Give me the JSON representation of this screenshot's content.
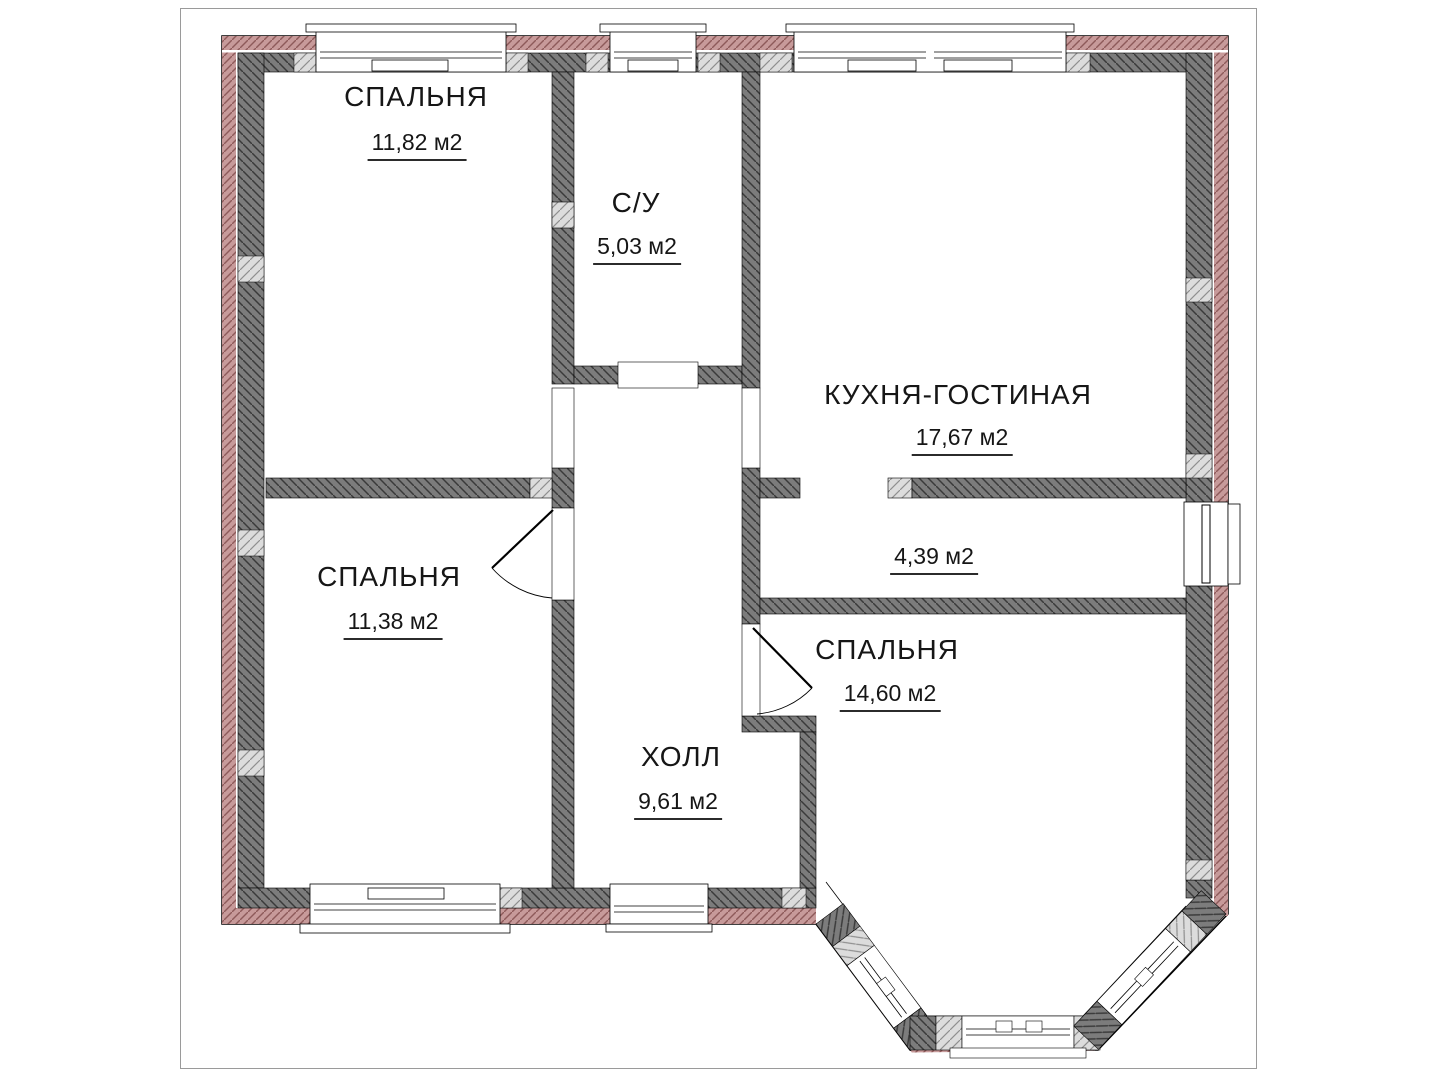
{
  "drawing": {
    "type": "architectural floor plan",
    "language": "ru",
    "area_unit": "м2"
  },
  "rooms": [
    {
      "id": "bedroom-top-left",
      "name": "СПАЛЬНЯ",
      "area": "11,82 м2"
    },
    {
      "id": "bathroom",
      "name": "С/У",
      "area": "5,03 м2"
    },
    {
      "id": "kitchen-living-room",
      "name": "КУХНЯ-ГОСТИНАЯ",
      "area": "17,67 м2"
    },
    {
      "id": "bedroom-middle-left",
      "name": "СПАЛЬНЯ",
      "area": "11,38 м2"
    },
    {
      "id": "corridor",
      "name": "",
      "area": "4,39 м2"
    },
    {
      "id": "bedroom-right",
      "name": "СПАЛЬНЯ",
      "area": "14,60 м2"
    },
    {
      "id": "hall",
      "name": "ХОЛЛ",
      "area": "9,61 м2"
    }
  ],
  "colors": {
    "brick_wall_fill": "#c79a9a",
    "brick_wall_hatch": "#8e5a5a",
    "block_wall_fill": "#7c7c7c",
    "block_wall_hatch": "#3a3a3a",
    "lintel_fill": "#dcdcdc",
    "lintel_hatch": "#8f8f8f",
    "outline": "#000000",
    "page_border": "#9a9a9a",
    "background": "#ffffff"
  },
  "features": {
    "windows_count": 7,
    "doors_count": 7,
    "bay_window": "bottom-right"
  }
}
